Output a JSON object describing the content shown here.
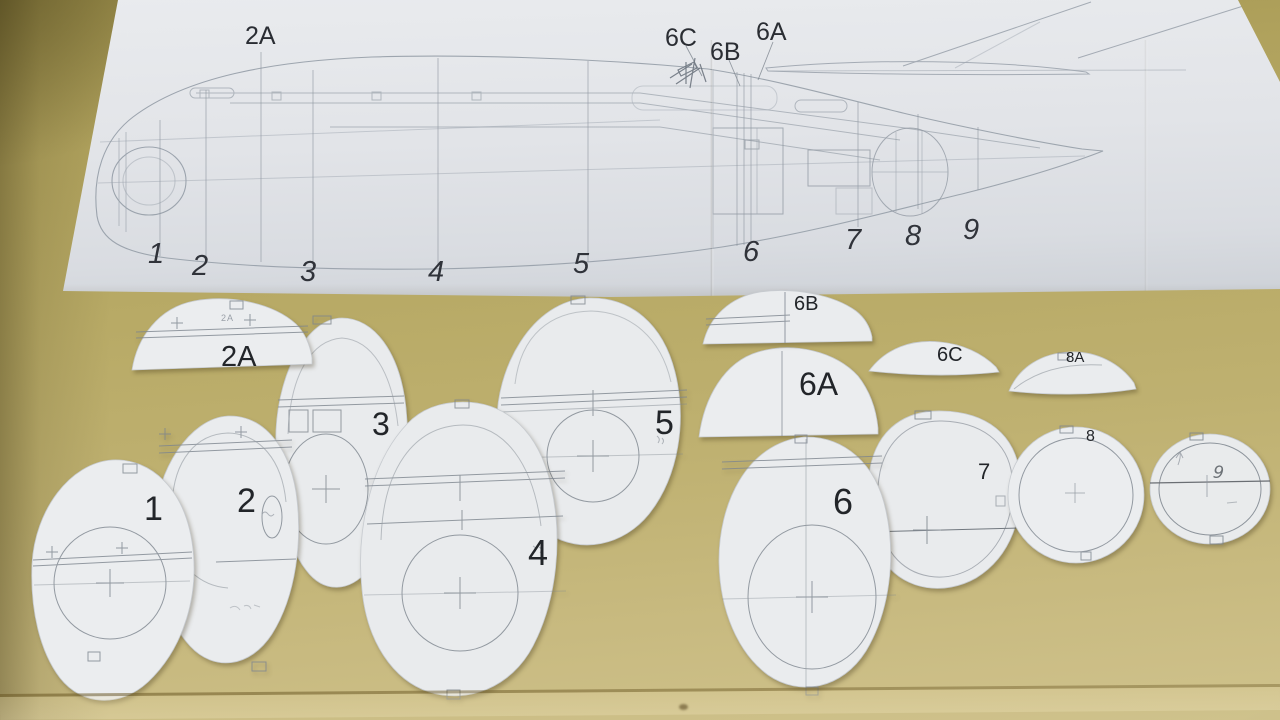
{
  "plan": {
    "stations": [
      {
        "label": "1"
      },
      {
        "label": "2"
      },
      {
        "label": "3"
      },
      {
        "label": "4"
      },
      {
        "label": "5"
      },
      {
        "label": "6"
      },
      {
        "label": "7"
      },
      {
        "label": "8"
      },
      {
        "label": "9"
      }
    ],
    "callouts": [
      {
        "label": "2A"
      },
      {
        "label": "6C"
      },
      {
        "label": "6B"
      },
      {
        "label": "6A"
      }
    ]
  },
  "formers": {
    "f1": {
      "label": "1"
    },
    "f2": {
      "label": "2"
    },
    "f2a": {
      "label": "2A",
      "small_print": "2A"
    },
    "f3": {
      "label": "3"
    },
    "f4": {
      "label": "4"
    },
    "f5": {
      "label": "5"
    },
    "f6": {
      "label": "6"
    },
    "f6a": {
      "label": "6A"
    },
    "f6b": {
      "label": "6B"
    },
    "f6c": {
      "label": "6C"
    },
    "f7": {
      "label": "7"
    },
    "f8": {
      "label": "8"
    },
    "f8a": {
      "label": "8A"
    },
    "f9": {
      "label": "9"
    }
  }
}
